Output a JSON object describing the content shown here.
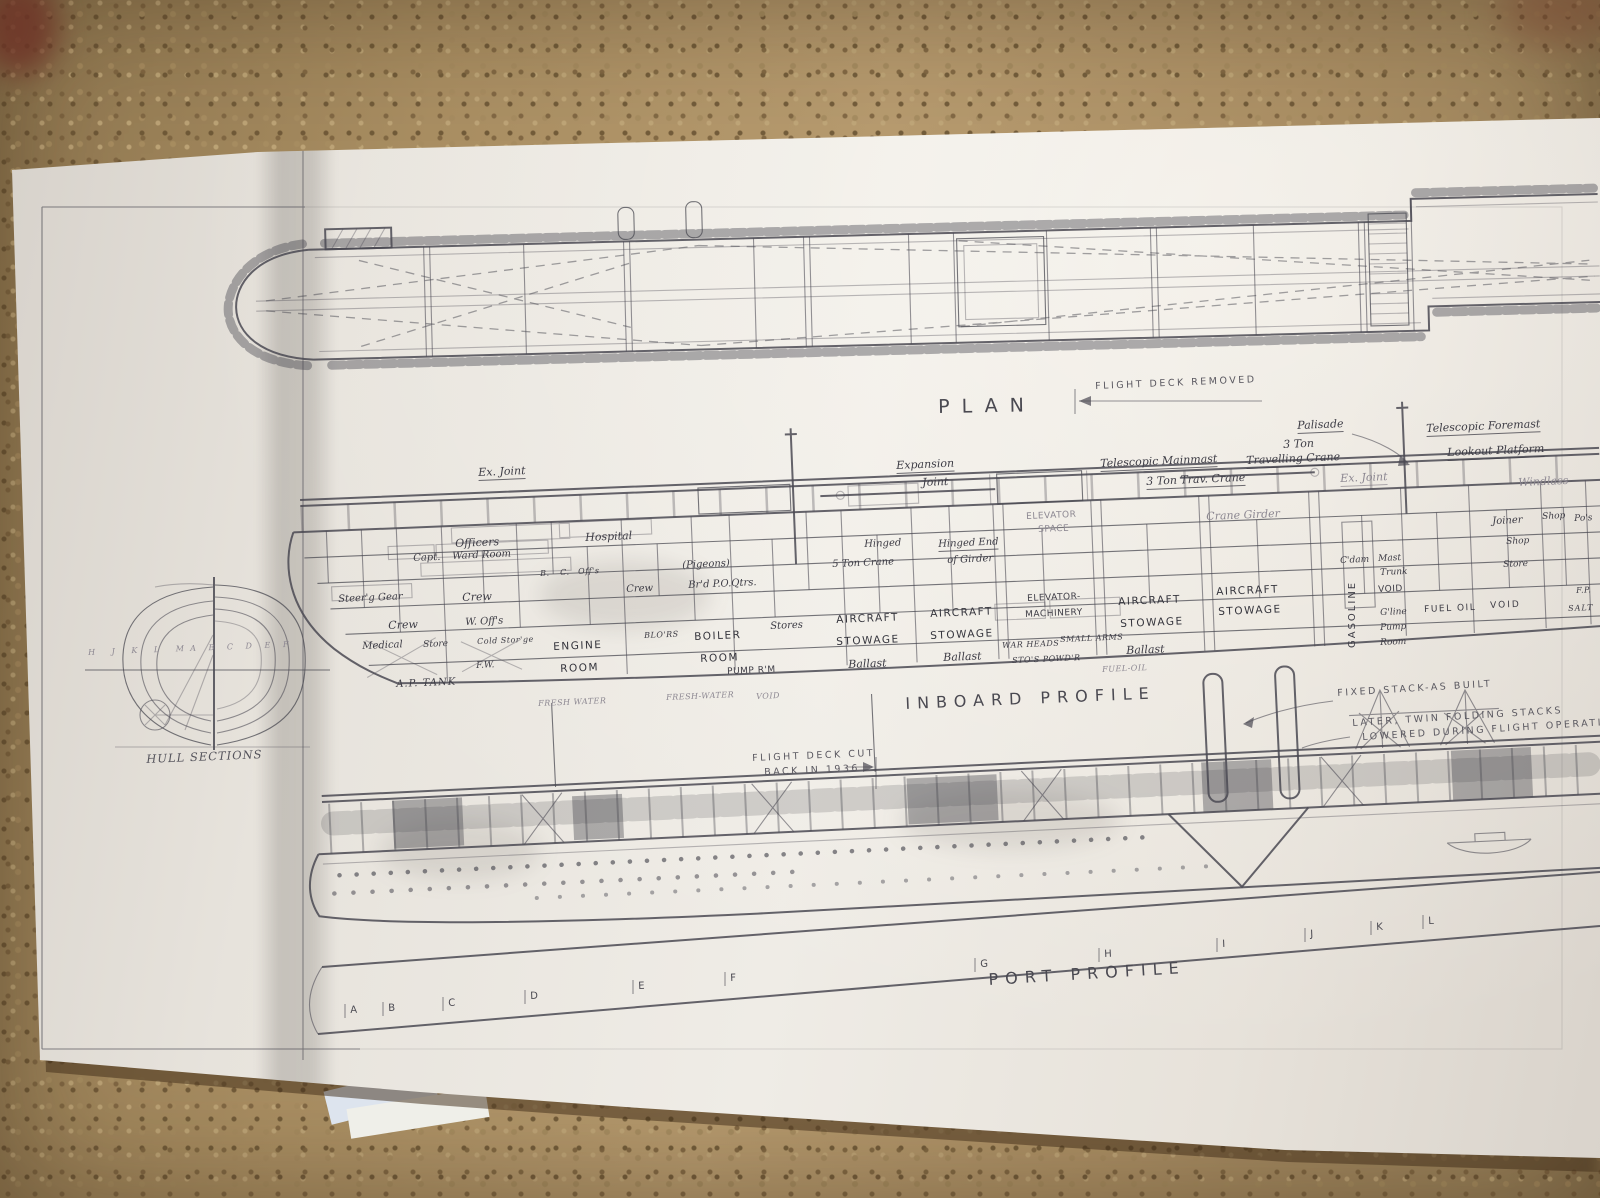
{
  "colors": {
    "paper": "#e9e5de",
    "carpet": "#a58b60",
    "ink": "#4a4952"
  },
  "plan": {
    "title": "PLAN",
    "note": "FLIGHT DECK REMOVED"
  },
  "inboard": {
    "title": "INBOARD PROFILE",
    "ann": {
      "ex_joint": "Ex. Joint",
      "expansion": "Expansion",
      "joint": "Joint",
      "tel_mainmast": "Telescopic Mainmast",
      "trav_crane": "3 Ton Trav. Crane",
      "palisade": "Palisade",
      "three_ton": "3 Ton",
      "travelling_crane": "Travelling Crane",
      "tel_foremast": "Telescopic Foremast",
      "lookout": "Lookout Platform",
      "ex_joint2": "Ex. Joint",
      "windlass": "Windlass",
      "crane_girder": "Crane Girder",
      "hinged": "Hinged",
      "five_ton_crane": "5 Ton Crane",
      "hinged_end": "Hinged End",
      "of_girder": "of Girder",
      "elevator": "ELEVATOR",
      "space": "SPACE"
    },
    "comp": {
      "officers": "Officers",
      "hospital": "Hospital",
      "capt": "Capt.",
      "ward_room": "Ward Room",
      "b": "B.",
      "c": "C.",
      "offs": "Off's",
      "pigeons": "(Pigeons)",
      "crew": "Crew",
      "po_qtrs": "Br'd P.O.Qtrs.",
      "w_offs": "W. Off's",
      "steer_gear": "Steer'g Gear",
      "medical": "Medical",
      "store": "Store",
      "cold_storage": "Cold Stor'ge",
      "ap_tank": "A.P. TANK",
      "fw": "F.W.",
      "engine": "ENGINE",
      "room": "ROOM",
      "blowers": "BLO'RS",
      "boiler": "BOILER",
      "pump_rm": "PUMP R'M",
      "stores": "Stores",
      "aircraft": "AIRCRAFT",
      "stowage": "STOWAGE",
      "ballast": "Ballast",
      "elevator_mach1": "ELEVATOR-",
      "elevator_mach2": "MACHINERY",
      "war_heads": "WAR HEADS",
      "small_arms": "SMALL ARMS",
      "powder": "STO'S POWD'R",
      "cdam": "C'dam",
      "mast": "Mast",
      "trunk": "Trunk",
      "void": "VOID",
      "gasoline": "GASOLINE",
      "gline": "G'line",
      "pump": "Pump",
      "room3": "Room",
      "fuel_oil": "FUEL OIL",
      "void2": "VOID",
      "joiner": "Joiner",
      "shop": "Shop",
      "store2": "Store",
      "shop2": "Shop",
      "pos": "Po's",
      "fp": "F.P.",
      "salt": "SALT",
      "fresh_water": "FRESH WATER",
      "fresh_water2": "FRESH-WATER",
      "void3": "VOID",
      "fuel_oil2": "FUEL-OIL"
    }
  },
  "port": {
    "title": "PORT PROFILE",
    "notes": {
      "fd_cut1": "FLIGHT DECK CUT",
      "fd_cut2": "BACK IN 1936",
      "fixed_stack": "FIXED STACK-AS BUILT",
      "later": "LATER, TWIN FOLDING STACKS",
      "lowered": "LOWERED DURING FLIGHT OPERATIONS"
    },
    "stations": [
      "A",
      "B",
      "C",
      "D",
      "E",
      "F",
      "G",
      "H",
      "I",
      "J",
      "K",
      "L"
    ]
  },
  "hull_sections": {
    "title": "HULL SECTIONS",
    "aft_letters": "H J K L M",
    "fwd_letters": "A B C D E F"
  }
}
